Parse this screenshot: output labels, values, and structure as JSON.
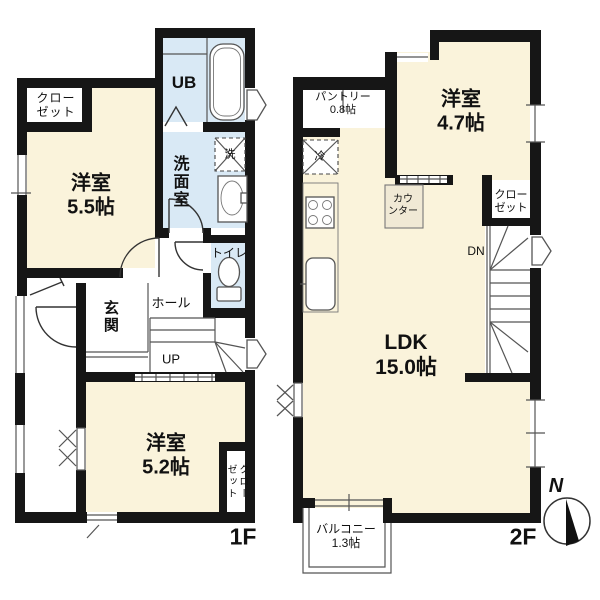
{
  "colors": {
    "floor_cream": "#FAF3DB",
    "wet_blue": "#D9E9F5",
    "wall": "#161616",
    "line": "#555555",
    "counter_fill": "#F0E9D5"
  },
  "floor1": {
    "floor_label": "1F",
    "rooms": {
      "closet_upper": {
        "line1": "クロー",
        "line2": "ゼット"
      },
      "bedroom55": {
        "line1": "洋室",
        "line2": "5.5帖"
      },
      "ub": {
        "label": "UB"
      },
      "washroom": {
        "label": "洗面室"
      },
      "washer": {
        "label": "洗"
      },
      "toilet": {
        "label": "トイレ"
      },
      "entrance": {
        "label": "玄関"
      },
      "hall": {
        "label": "ホール"
      },
      "stairs": {
        "label": "UP"
      },
      "bedroom52": {
        "line1": "洋室",
        "line2": "5.2帖"
      },
      "closet_lower": {
        "line1": "クロー",
        "line2": "ゼット"
      }
    }
  },
  "floor2": {
    "floor_label": "2F",
    "rooms": {
      "pantry": {
        "line1": "パントリー",
        "line2": "0.8帖"
      },
      "fridge": {
        "label": "冷"
      },
      "bedroom47": {
        "line1": "洋室",
        "line2": "4.7帖"
      },
      "closet": {
        "line1": "クロー",
        "line2": "ゼット"
      },
      "counter": {
        "line1": "カウ",
        "line2": "ンター"
      },
      "stairs": {
        "label": "DN"
      },
      "ldk": {
        "line1": "LDK",
        "line2": "15.0帖"
      },
      "balcony": {
        "line1": "バルコニー",
        "line2": "1.3帖"
      }
    },
    "compass": {
      "label": "N"
    }
  }
}
